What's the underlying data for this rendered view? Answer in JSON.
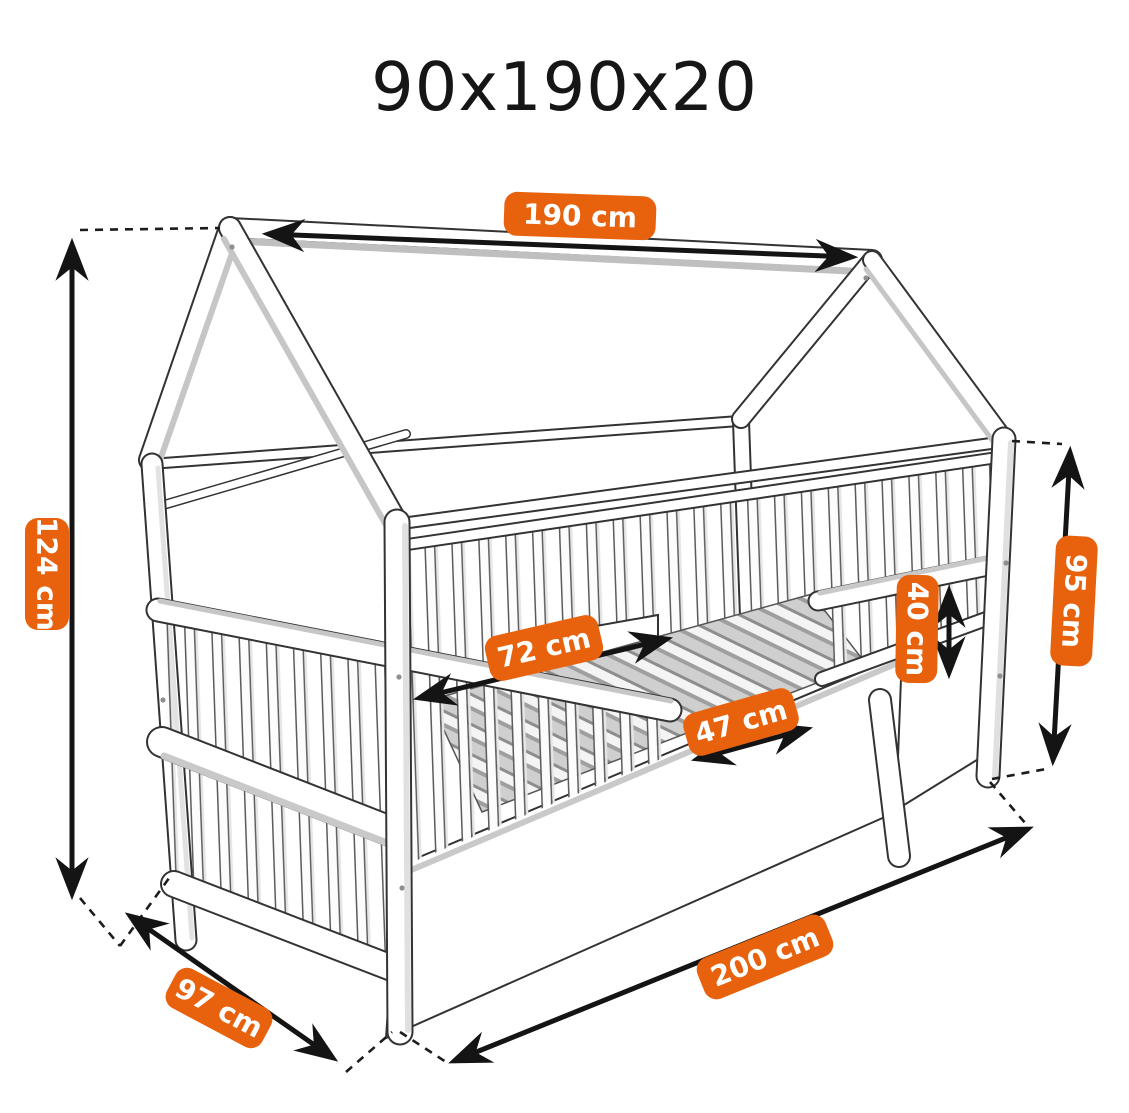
{
  "title": "90x190x20",
  "diagram": {
    "accent_color": "#e8620e",
    "line_color": "#141414",
    "dimensions": {
      "ridge_length": "190 cm",
      "total_height": "124 cm",
      "total_width": "97 cm",
      "total_length": "200 cm",
      "post_height": "95 cm",
      "guard_rail_height": "40 cm",
      "side_rail_length": "72 cm",
      "entrance_width": "47 cm"
    }
  }
}
